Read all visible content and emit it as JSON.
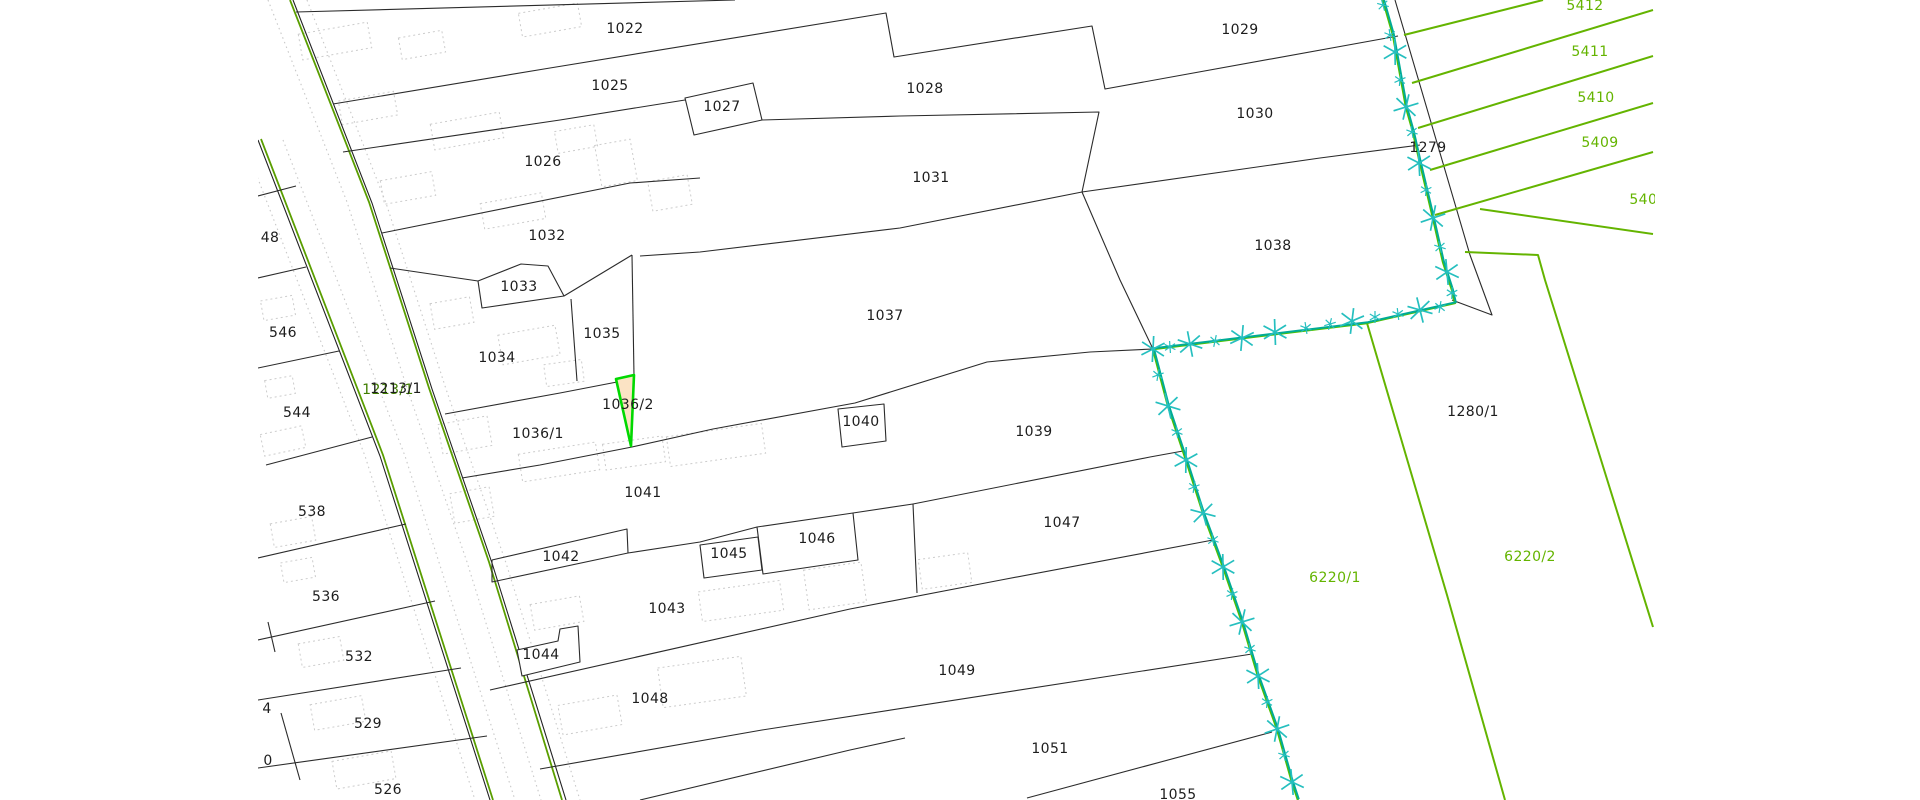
{
  "map": {
    "title": "cadastral-parcel-map",
    "selected_parcel": {
      "id": "1036/2",
      "fill": "#fbe3c4",
      "outline": "#00d900"
    },
    "road_label": {
      "text": "1213/1"
    },
    "colors": {
      "background": "#ffffff",
      "parcel_line": "#2b2b2b",
      "green_parcel_line": "#64b400",
      "road_edge_green": "#5a9e00",
      "surveyed_boundary_teal": "#00ab96",
      "surveyed_boundary_under_green": "#4fc000",
      "marker_teal": "#25bfbf",
      "building_dashed_gray": "#cccccc",
      "selected_fill": "#fbe3c4",
      "selected_outline": "#00d900"
    },
    "labels": [
      {
        "t": "1022",
        "x": 625,
        "y": 33,
        "c": "k"
      },
      {
        "t": "1025",
        "x": 610,
        "y": 90,
        "c": "k"
      },
      {
        "t": "1026",
        "x": 543,
        "y": 166,
        "c": "k"
      },
      {
        "t": "1027",
        "x": 722,
        "y": 111,
        "c": "k"
      },
      {
        "t": "1028",
        "x": 925,
        "y": 93,
        "c": "k"
      },
      {
        "t": "1029",
        "x": 1240,
        "y": 34,
        "c": "k"
      },
      {
        "t": "1030",
        "x": 1255,
        "y": 118,
        "c": "k"
      },
      {
        "t": "1031",
        "x": 931,
        "y": 182,
        "c": "k"
      },
      {
        "t": "1032",
        "x": 547,
        "y": 240,
        "c": "k"
      },
      {
        "t": "1033",
        "x": 519,
        "y": 291,
        "c": "k"
      },
      {
        "t": "1034",
        "x": 497,
        "y": 362,
        "c": "k"
      },
      {
        "t": "1035",
        "x": 602,
        "y": 338,
        "c": "k"
      },
      {
        "t": "1036/1",
        "x": 538,
        "y": 438,
        "c": "k"
      },
      {
        "t": "1036/2",
        "x": 628,
        "y": 409,
        "c": "k"
      },
      {
        "t": "1037",
        "x": 885,
        "y": 320,
        "c": "k"
      },
      {
        "t": "1038",
        "x": 1273,
        "y": 250,
        "c": "k"
      },
      {
        "t": "1039",
        "x": 1034,
        "y": 436,
        "c": "k"
      },
      {
        "t": "1040",
        "x": 861,
        "y": 426,
        "c": "k"
      },
      {
        "t": "1041",
        "x": 643,
        "y": 497,
        "c": "k"
      },
      {
        "t": "1042",
        "x": 561,
        "y": 561,
        "c": "k"
      },
      {
        "t": "1043",
        "x": 667,
        "y": 613,
        "c": "k"
      },
      {
        "t": "1044",
        "x": 541,
        "y": 659,
        "c": "k"
      },
      {
        "t": "1045",
        "x": 729,
        "y": 558,
        "c": "k"
      },
      {
        "t": "1046",
        "x": 817,
        "y": 543,
        "c": "k"
      },
      {
        "t": "1047",
        "x": 1062,
        "y": 527,
        "c": "k"
      },
      {
        "t": "1048",
        "x": 650,
        "y": 703,
        "c": "k"
      },
      {
        "t": "1049",
        "x": 957,
        "y": 675,
        "c": "k"
      },
      {
        "t": "1051",
        "x": 1050,
        "y": 753,
        "c": "k"
      },
      {
        "t": "1055",
        "x": 1178,
        "y": 799,
        "c": "k"
      },
      {
        "t": "1279",
        "x": 1428,
        "y": 152,
        "c": "k"
      },
      {
        "t": "1280/1",
        "x": 1473,
        "y": 416,
        "c": "k"
      },
      {
        "t": "546",
        "x": 283,
        "y": 337,
        "c": "k"
      },
      {
        "t": "544",
        "x": 297,
        "y": 417,
        "c": "k"
      },
      {
        "t": "538",
        "x": 312,
        "y": 516,
        "c": "k"
      },
      {
        "t": "536",
        "x": 326,
        "y": 601,
        "c": "k"
      },
      {
        "t": "532",
        "x": 359,
        "y": 661,
        "c": "k"
      },
      {
        "t": "529",
        "x": 368,
        "y": 728,
        "c": "k"
      },
      {
        "t": "526",
        "x": 388,
        "y": 794,
        "c": "k"
      },
      {
        "t": "48",
        "x": 270,
        "y": 242,
        "c": "k"
      },
      {
        "t": "4",
        "x": 267,
        "y": 713,
        "c": "k"
      },
      {
        "t": "0",
        "x": 268,
        "y": 765,
        "c": "k"
      },
      {
        "t": "5412",
        "x": 1585,
        "y": 10,
        "c": "g"
      },
      {
        "t": "5411",
        "x": 1590,
        "y": 56,
        "c": "g"
      },
      {
        "t": "5410",
        "x": 1596,
        "y": 102,
        "c": "g"
      },
      {
        "t": "5409",
        "x": 1600,
        "y": 147,
        "c": "g"
      },
      {
        "t": "5408",
        "x": 1648,
        "y": 204,
        "c": "g"
      },
      {
        "t": "6220/1",
        "x": 1335,
        "y": 582,
        "c": "g"
      },
      {
        "t": "6220/2",
        "x": 1530,
        "y": 561,
        "c": "g"
      }
    ],
    "boundary_markers": [
      {
        "x": 1383,
        "y": 5,
        "s": "s"
      },
      {
        "x": 1390,
        "y": 35,
        "s": "s"
      },
      {
        "x": 1395,
        "y": 52,
        "s": "b"
      },
      {
        "x": 1400,
        "y": 80,
        "s": "s"
      },
      {
        "x": 1406,
        "y": 107,
        "s": "b"
      },
      {
        "x": 1412,
        "y": 132,
        "s": "s"
      },
      {
        "x": 1419,
        "y": 163,
        "s": "b"
      },
      {
        "x": 1426,
        "y": 190,
        "s": "s"
      },
      {
        "x": 1433,
        "y": 218,
        "s": "b"
      },
      {
        "x": 1440,
        "y": 247,
        "s": "s"
      },
      {
        "x": 1447,
        "y": 272,
        "s": "b"
      },
      {
        "x": 1452,
        "y": 293,
        "s": "s"
      },
      {
        "x": 1440,
        "y": 307,
        "s": "s"
      },
      {
        "x": 1420,
        "y": 310,
        "s": "b"
      },
      {
        "x": 1398,
        "y": 314,
        "s": "s"
      },
      {
        "x": 1375,
        "y": 317,
        "s": "s"
      },
      {
        "x": 1352,
        "y": 321,
        "s": "b"
      },
      {
        "x": 1330,
        "y": 324,
        "s": "s"
      },
      {
        "x": 1306,
        "y": 328,
        "s": "s"
      },
      {
        "x": 1275,
        "y": 332,
        "s": "b"
      },
      {
        "x": 1242,
        "y": 338,
        "s": "b"
      },
      {
        "x": 1215,
        "y": 341,
        "s": "s"
      },
      {
        "x": 1190,
        "y": 344,
        "s": "b"
      },
      {
        "x": 1170,
        "y": 347,
        "s": "s"
      },
      {
        "x": 1153,
        "y": 349,
        "s": "b"
      },
      {
        "x": 1158,
        "y": 375,
        "s": "s"
      },
      {
        "x": 1168,
        "y": 406,
        "s": "b"
      },
      {
        "x": 1177,
        "y": 432,
        "s": "s"
      },
      {
        "x": 1186,
        "y": 460,
        "s": "b"
      },
      {
        "x": 1194,
        "y": 487,
        "s": "s"
      },
      {
        "x": 1203,
        "y": 513,
        "s": "b"
      },
      {
        "x": 1213,
        "y": 540,
        "s": "s"
      },
      {
        "x": 1223,
        "y": 567,
        "s": "b"
      },
      {
        "x": 1232,
        "y": 594,
        "s": "s"
      },
      {
        "x": 1242,
        "y": 622,
        "s": "b"
      },
      {
        "x": 1250,
        "y": 649,
        "s": "s"
      },
      {
        "x": 1258,
        "y": 676,
        "s": "b"
      },
      {
        "x": 1267,
        "y": 702,
        "s": "s"
      },
      {
        "x": 1277,
        "y": 729,
        "s": "b"
      },
      {
        "x": 1284,
        "y": 755,
        "s": "s"
      },
      {
        "x": 1292,
        "y": 782,
        "s": "b"
      }
    ]
  }
}
